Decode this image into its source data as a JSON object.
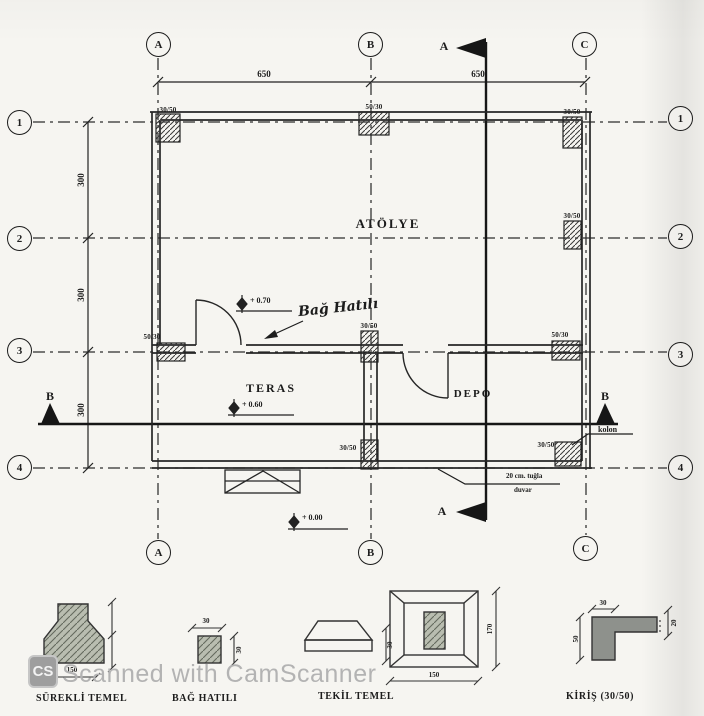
{
  "drawing": {
    "grid": {
      "cols": [
        "A",
        "B",
        "C"
      ],
      "rows": [
        "1",
        "2",
        "3",
        "4"
      ]
    },
    "dims": {
      "top": [
        "650",
        "650"
      ],
      "left": [
        "300",
        "300",
        "300"
      ]
    },
    "section_a": "A",
    "section_b": "B",
    "rooms": {
      "atolye": "ATÖLYE",
      "teras": "TERAS",
      "depo": "DEPO"
    },
    "levels": {
      "atolye": "+ 0.70",
      "teras": "+ 0.60",
      "ground": "+ 0.00"
    },
    "notes": {
      "bag_hatili": "Bağ Hatılı",
      "kolon": "kolon",
      "tugla1": "20 cm. tuğla",
      "tugla2": "duvar"
    },
    "columns": {
      "a1": "30/50",
      "b1": "50/30",
      "c1": "30/50",
      "c2": "30/50",
      "a3": "50/30",
      "b3": "30/50",
      "c3": "50/30",
      "b4": "30/50",
      "c4": "30/50"
    }
  },
  "legend": {
    "surekli": {
      "label": "SÜREKLİ TEMEL",
      "dim_bottom": "150"
    },
    "bag": {
      "label": "BAĞ HATILI",
      "dim_top": "30",
      "dim_right": "30"
    },
    "tekil": {
      "label": "TEKİL TEMEL",
      "dim_side": "30",
      "dim_bottom": "150",
      "dim_right": "170"
    },
    "kiris": {
      "label": "KİRİŞ (30/50)",
      "dim_top": "30",
      "dim_left": "50",
      "dim_right": "20"
    }
  },
  "watermark": {
    "logo": "CS",
    "text": "Scanned with CamScanner"
  },
  "colors": {
    "ink": "#222222",
    "paper": "#f6f5f1",
    "watermark_gray": "#b3b3b3",
    "fill_gray": "#8e918c"
  }
}
